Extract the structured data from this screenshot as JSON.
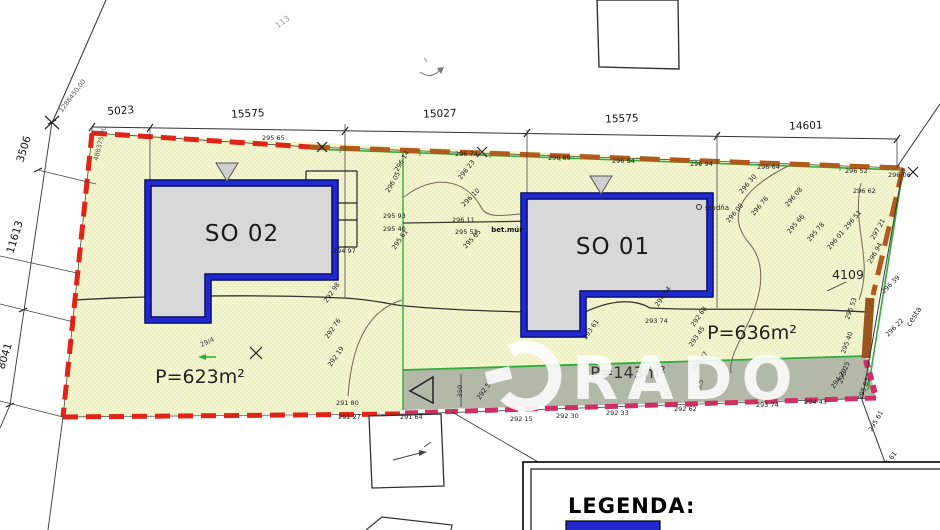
{
  "plan": {
    "buildings": {
      "so02": "SO 02",
      "so01": "SO 01"
    },
    "areas": {
      "plot_left": "P=623m²",
      "plot_right": "P=636m²",
      "road": "P=143m²"
    },
    "parcel_number": "4109",
    "labels": {
      "studna": "studňa",
      "betmur": "bet.múr",
      "cesta": "cesta"
    },
    "legend": {
      "title": "LEGENDA:"
    },
    "watermark": {
      "text": "RADO"
    },
    "colors": {
      "red": "#e02417",
      "orange": "#b05a1c",
      "magenta": "#cf2f62",
      "green": "#2fae3a",
      "blue": "#2128cc",
      "bfill": "#d8d8d8",
      "parcel": "#f4f6cf",
      "road": "#b4b8a8"
    },
    "dims_top": [
      {
        "x": 121,
        "y": 114,
        "r": -4,
        "t": "5023"
      },
      {
        "x": 248,
        "y": 117,
        "r": -3,
        "t": "15575"
      },
      {
        "x": 440,
        "y": 117,
        "r": -2,
        "t": "15027"
      },
      {
        "x": 622,
        "y": 122,
        "r": -2,
        "t": "15575"
      },
      {
        "x": 806,
        "y": 129,
        "r": -2,
        "t": "14601"
      }
    ],
    "dims_left": [
      {
        "x": 27,
        "y": 150,
        "r": -73,
        "t": "3506"
      },
      {
        "x": 18,
        "y": 238,
        "r": -73,
        "t": "11613"
      },
      {
        "x": 8,
        "y": 357,
        "r": -73,
        "t": "8041"
      }
    ],
    "coords": [
      {
        "x": 74,
        "y": 97,
        "r": -53,
        "t": "1288450.00"
      },
      {
        "x": 102,
        "y": 144,
        "r": -76,
        "t": "488375.00"
      }
    ],
    "misc": [
      {
        "x": 462,
        "y": 391,
        "r": -90,
        "t": "350"
      },
      {
        "x": 702,
        "y": 385,
        "r": -78,
        "t": "3,5"
      },
      {
        "x": 208,
        "y": 344,
        "r": -25,
        "t": "29/4"
      },
      {
        "x": 284,
        "y": 24,
        "r": -35,
        "t": "113",
        "c": "t-faint"
      }
    ],
    "spots": [
      {
        "x": 262,
        "y": 140,
        "t": "295 65"
      },
      {
        "x": 455,
        "y": 156,
        "t": "296 74"
      },
      {
        "x": 548,
        "y": 160,
        "t": "296 89"
      },
      {
        "x": 612,
        "y": 163,
        "t": "296 94"
      },
      {
        "x": 690,
        "y": 166,
        "t": "296 94"
      },
      {
        "x": 757,
        "y": 169,
        "t": "296 64"
      },
      {
        "x": 845,
        "y": 173,
        "t": "296 52"
      },
      {
        "x": 888,
        "y": 177,
        "t": "296 06"
      },
      {
        "x": 853,
        "y": 193,
        "t": "296 62"
      },
      {
        "x": 398,
        "y": 172,
        "r": -60,
        "t": "296 14"
      },
      {
        "x": 389,
        "y": 193,
        "r": -60,
        "t": "296 05"
      },
      {
        "x": 461,
        "y": 180,
        "r": -52,
        "t": "296 23"
      },
      {
        "x": 464,
        "y": 207,
        "r": -45,
        "t": "296 10"
      },
      {
        "x": 383,
        "y": 218,
        "t": "295 93"
      },
      {
        "x": 383,
        "y": 231,
        "t": "295 40"
      },
      {
        "x": 452,
        "y": 222,
        "t": "296 11"
      },
      {
        "x": 455,
        "y": 234,
        "t": "295 51"
      },
      {
        "x": 333,
        "y": 253,
        "t": "294 97"
      },
      {
        "x": 395,
        "y": 250,
        "r": -55,
        "t": "295 61"
      },
      {
        "x": 466,
        "y": 249,
        "r": -48,
        "t": "295 65"
      },
      {
        "x": 327,
        "y": 303,
        "r": -55,
        "t": "292 98"
      },
      {
        "x": 328,
        "y": 339,
        "r": -55,
        "t": "292 76"
      },
      {
        "x": 331,
        "y": 367,
        "r": -55,
        "t": "292 19"
      },
      {
        "x": 742,
        "y": 194,
        "r": -50,
        "t": "296 30"
      },
      {
        "x": 729,
        "y": 223,
        "r": -50,
        "t": "296 09"
      },
      {
        "x": 754,
        "y": 216,
        "r": -50,
        "t": "296 76"
      },
      {
        "x": 788,
        "y": 207,
        "r": -50,
        "t": "296 08"
      },
      {
        "x": 790,
        "y": 234,
        "r": -50,
        "t": "295 66"
      },
      {
        "x": 810,
        "y": 242,
        "r": -50,
        "t": "295 78"
      },
      {
        "x": 830,
        "y": 250,
        "r": -50,
        "t": "296 01"
      },
      {
        "x": 847,
        "y": 230,
        "r": -50,
        "t": "296 51"
      },
      {
        "x": 874,
        "y": 240,
        "r": -60,
        "t": "297 21"
      },
      {
        "x": 871,
        "y": 264,
        "r": -60,
        "t": "296 94"
      },
      {
        "x": 884,
        "y": 294,
        "r": -45,
        "t": "296 39"
      },
      {
        "x": 888,
        "y": 337,
        "r": -45,
        "t": "296 22"
      },
      {
        "x": 586,
        "y": 340,
        "r": -55,
        "t": "293 61"
      },
      {
        "x": 658,
        "y": 307,
        "r": -55,
        "t": "294 54"
      },
      {
        "x": 694,
        "y": 327,
        "r": -55,
        "t": "292 68"
      },
      {
        "x": 692,
        "y": 347,
        "r": -55,
        "t": "293 45"
      },
      {
        "x": 695,
        "y": 372,
        "r": -55,
        "t": "294 27"
      },
      {
        "x": 480,
        "y": 400,
        "r": -55,
        "t": "292 54"
      },
      {
        "x": 834,
        "y": 389,
        "r": -55,
        "t": "294 29"
      },
      {
        "x": 645,
        "y": 323,
        "t": "293 74"
      },
      {
        "x": 336,
        "y": 405,
        "t": "291 80"
      },
      {
        "x": 338,
        "y": 419,
        "t": "291 27"
      },
      {
        "x": 400,
        "y": 419,
        "t": "291 64"
      },
      {
        "x": 510,
        "y": 421,
        "t": "292 15"
      },
      {
        "x": 556,
        "y": 418,
        "t": "292 30"
      },
      {
        "x": 606,
        "y": 415,
        "t": "292 33"
      },
      {
        "x": 674,
        "y": 411,
        "t": "292 62"
      },
      {
        "x": 756,
        "y": 407,
        "t": "293 74"
      },
      {
        "x": 804,
        "y": 404,
        "t": "294 43"
      },
      {
        "x": 849,
        "y": 320,
        "r": -70,
        "t": "295 53"
      },
      {
        "x": 845,
        "y": 354,
        "r": -70,
        "t": "295 40"
      },
      {
        "x": 842,
        "y": 384,
        "r": -70,
        "t": "295 25"
      },
      {
        "x": 862,
        "y": 400,
        "r": -70,
        "t": "295 83"
      },
      {
        "x": 872,
        "y": 432,
        "r": -60,
        "t": "295 61"
      },
      {
        "x": 884,
        "y": 472,
        "r": -55,
        "t": "296 61"
      }
    ]
  }
}
